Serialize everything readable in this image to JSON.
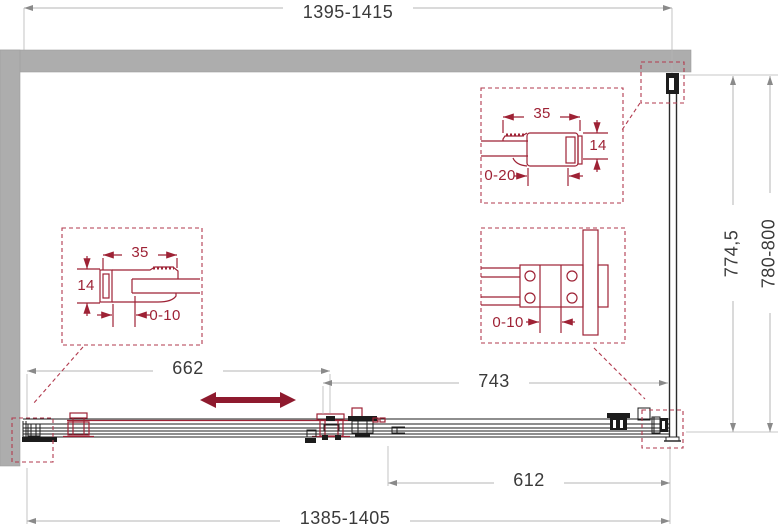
{
  "title": "Sliding shower enclosure technical drawing (plan view)",
  "colors": {
    "wall_gray": "#adadad",
    "detail_red": "#9e2235",
    "dashed_red": "#b23a4e",
    "arrow_red": "#8e1a2e",
    "dim_line": "#b5b5b5",
    "dim_text": "#3a3a3a",
    "track_black": "#1c1c1c"
  },
  "dimensions": {
    "top_width": "1395-1415",
    "bottom_width": "1385-1405",
    "door_travel": "612",
    "fixed_section": "743",
    "opening": "662",
    "depth_glass": "774,5",
    "depth_overall": "780-800"
  },
  "callouts": {
    "left_profile": {
      "width": "35",
      "depth": "14",
      "adjustment": "0-10"
    },
    "right_profile": {
      "width": "35",
      "depth": "14",
      "adjustment": "0-20"
    },
    "roller_detail": {
      "adjustment": "0-10"
    }
  }
}
